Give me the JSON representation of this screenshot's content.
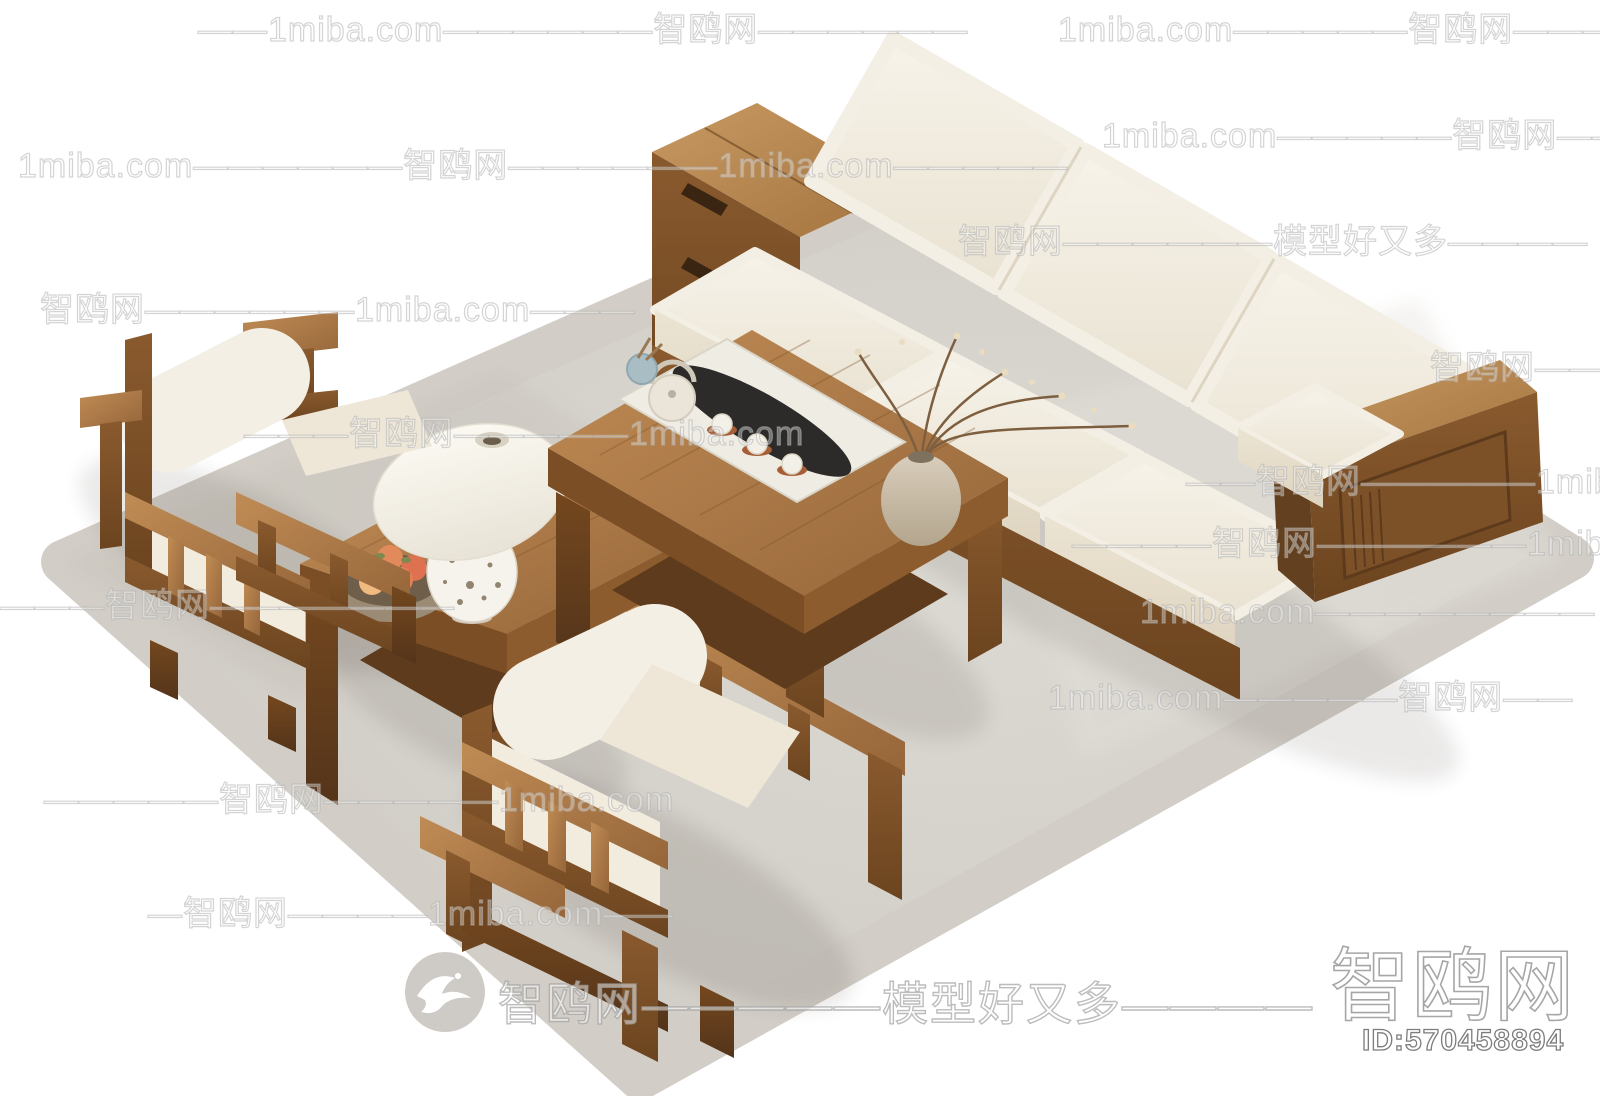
{
  "page": {
    "background": "#ffffff",
    "width": 1600,
    "height": 1096,
    "kind": "3d-model marketplace product render (no UI chrome)"
  },
  "watermarks": {
    "items": [
      {
        "text": "——1miba.com——————智鸥网——————",
        "x": 198,
        "y": 12
      },
      {
        "text": "1miba.com—————智鸥网———",
        "x": 1058,
        "y": 12
      },
      {
        "text": "1miba.com——————智鸥网——————1miba.com—————",
        "x": 18,
        "y": 148
      },
      {
        "text": "1miba.com—————智鸥网——",
        "x": 1102,
        "y": 118
      },
      {
        "text": "智鸥网——————模型好又多————",
        "x": 958,
        "y": 224
      },
      {
        "text": "智鸥网——————1miba.com———",
        "x": 40,
        "y": 292
      },
      {
        "text": "智鸥网————",
        "x": 1430,
        "y": 350
      },
      {
        "text": "———智鸥网—————1miba.com",
        "x": 244,
        "y": 416
      },
      {
        "text": "——智鸥网—————1miba.com",
        "x": 1186,
        "y": 464
      },
      {
        "text": "————智鸥网——————1miba.com",
        "x": 1072,
        "y": 526
      },
      {
        "text": "—————智鸥网———————",
        "x": -70,
        "y": 588
      },
      {
        "text": "1miba.com————————",
        "x": 1140,
        "y": 594
      },
      {
        "text": "1miba.com—————智鸥网——",
        "x": 1048,
        "y": 680
      },
      {
        "text": "—————智鸥网—————1miba.com",
        "x": 44,
        "y": 782
      },
      {
        "text": "—智鸥网————1miba.com——",
        "x": 148,
        "y": 896
      }
    ],
    "center_banner": {
      "logo": "seagull-logo",
      "text": "智鸥网—————模型好又多————"
    },
    "corner": {
      "brand": "智鸥网",
      "id_label": "ID:570458894"
    }
  },
  "scene": {
    "type": "isometric living-room furniture set on white background",
    "furniture": [
      "three-seat solid wood sofa with white cushions and storage-cabinet armrest",
      "solid wood armchair with white cushions (upper left, seen from back)",
      "solid wood armchair with white cushions (front center, seen from back)",
      "wooden coffee table with white runner, black tea-boat tray, teapot, three cups, blue utensil cup and ceramic vase with dried branches",
      "wooden corner side table with white table lamp and bowl of peaches",
      "light gray area rug"
    ],
    "colors": {
      "wood_light": "#b5824f",
      "wood_mid": "#8a5a2e",
      "wood_dark": "#64401d",
      "cushion": "#f2ede1",
      "rug": "#d5d1ca",
      "tea_tray_black": "#2c2b29",
      "utensil_cup_blue": "#a9bdc5",
      "saucer_terracotta": "#a65e36",
      "peach": "#e29a63",
      "background": "#ffffff"
    }
  }
}
